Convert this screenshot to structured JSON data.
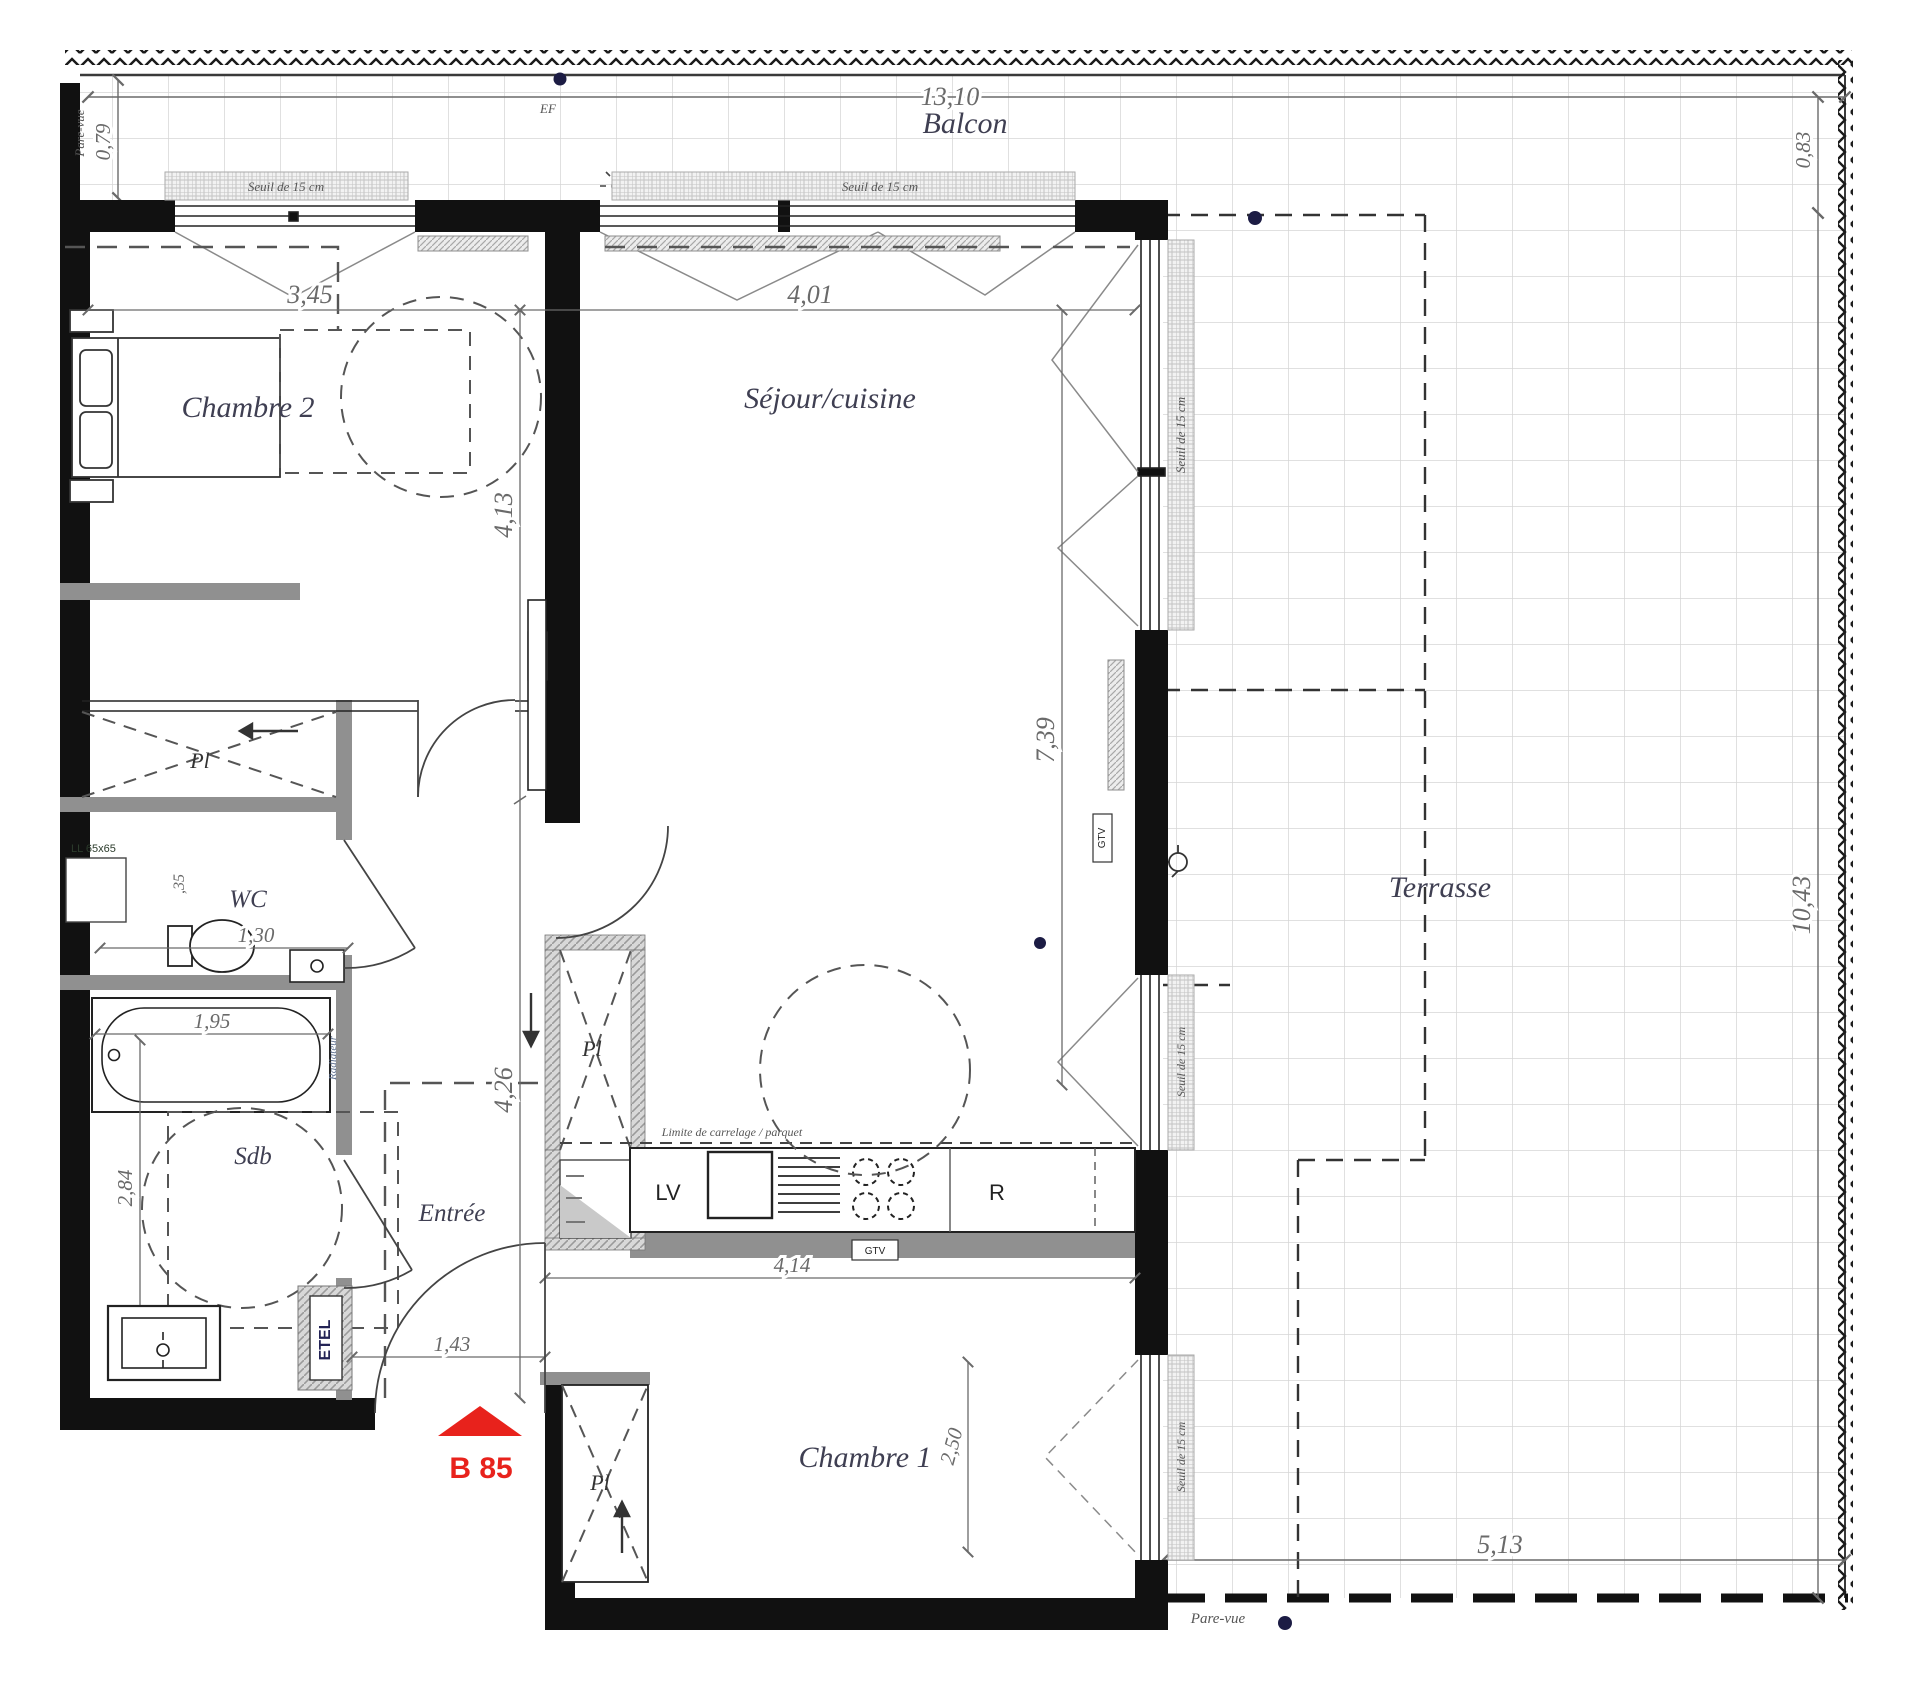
{
  "plan": {
    "title": "Plan d'appartement B 85",
    "unit": {
      "label": "B 85",
      "marker_color": "#e8221c"
    },
    "rooms": {
      "balcon": "Balcon",
      "terrasse": "Terrasse",
      "chambre2": "Chambre 2",
      "sejour": "Séjour/cuisine",
      "chambre1": "Chambre 1",
      "entree": "Entrée",
      "wc": "WC",
      "sdb": "Sdb"
    },
    "dims": {
      "d1310": "13,10",
      "d079": "0,79",
      "d083": "0,83",
      "d1043": "10,43",
      "d513": "5,13",
      "d345": "3,45",
      "d401": "4,01",
      "d413": "4,13",
      "d426": "4,26",
      "d739": "7,39",
      "d130": "1,30",
      "d195": "1,95",
      "d284": "2,84",
      "d035": ",35",
      "d143": "1,43",
      "d414": "4,14",
      "d250": "2,50"
    },
    "annotations": {
      "seuil": "Seuil de 15 cm",
      "pare_vue": "Pare-vue",
      "limite": "Limite de carrelage / parquet",
      "ll": "LL 65x65",
      "etel": "ETEL",
      "ef": "EF",
      "gtv": "GTV",
      "lv": "LV",
      "r": "R",
      "pl": "Pl",
      "radiateur": "Radiateur"
    },
    "colors": {
      "wall": "#111111",
      "partition": "#909090",
      "accent_red": "#e8221c",
      "dot_navy": "#1c1c44",
      "tile_line": "#d6d6d6",
      "dim_gray": "#6a6a6a"
    }
  }
}
